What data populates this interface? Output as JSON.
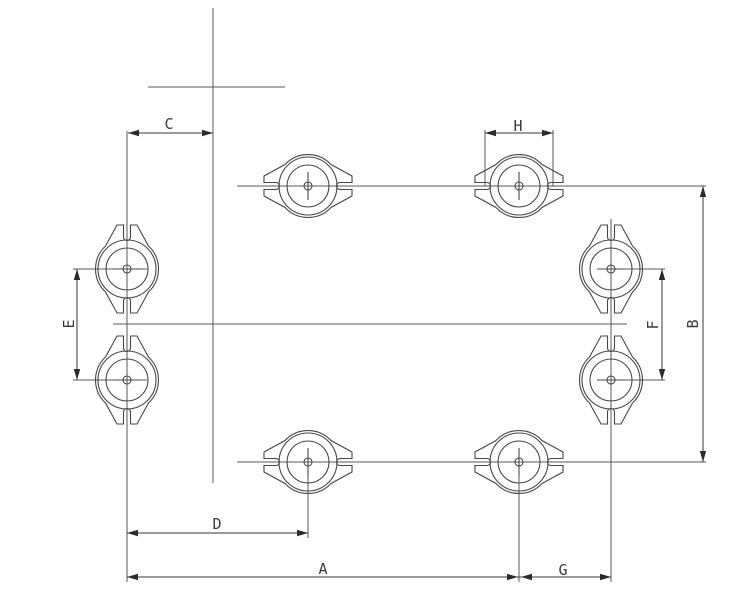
{
  "drawing": {
    "colors": {
      "background": "#ffffff",
      "centerline": "#585858",
      "dimension_line": "#3a3a3a",
      "part_outline": "#474747",
      "label_text": "#3a3a3a"
    },
    "dimensions": {
      "a": {
        "label": "A"
      },
      "b": {
        "label": "B"
      },
      "c": {
        "label": "C"
      },
      "d": {
        "label": "D"
      },
      "e": {
        "label": "E"
      },
      "f": {
        "label": "F"
      },
      "g": {
        "label": "G"
      },
      "h": {
        "label": "H"
      }
    }
  }
}
